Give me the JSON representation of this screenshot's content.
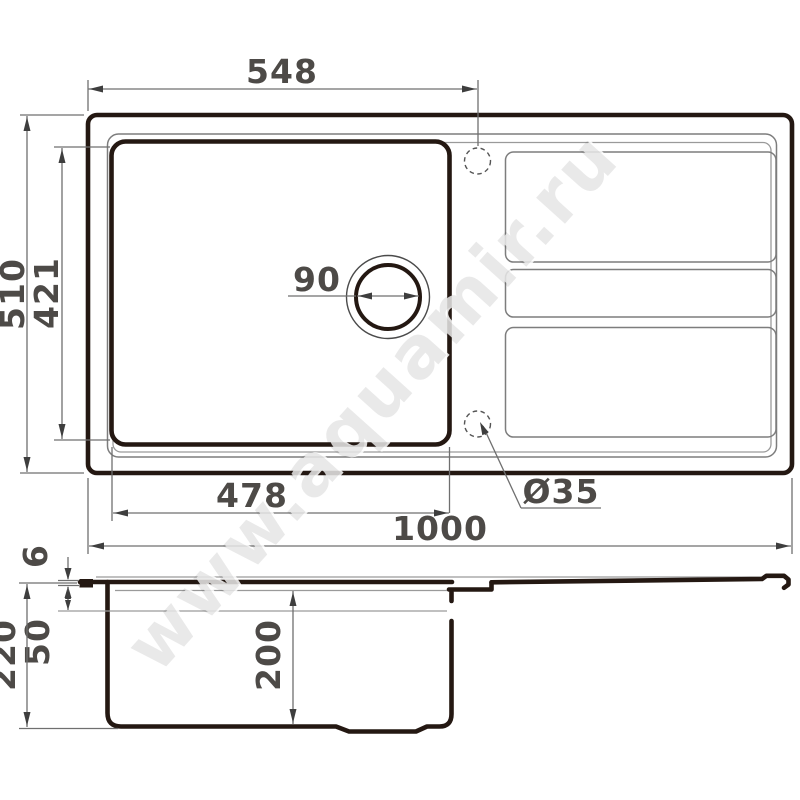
{
  "drawing_title": "kitchen-sink-dimension-drawing",
  "dimensions": {
    "top_width_to_hole": "548",
    "overall_depth": "510",
    "bowl_inner_length": "421",
    "drain_diameter": "90",
    "bowl_width": "478",
    "overall_width": "1000",
    "faucet_hole_diameter": "Ø35",
    "rim_edge_thickness": "6",
    "rim_ledge_height": "50",
    "overall_height": "220",
    "bowl_inner_depth": "200"
  },
  "watermark": "www.aquamir.ru",
  "colors": {
    "outline_thick": "#241812",
    "outline_thin": "#7d7d7d",
    "dimension_text": "#4d4a47",
    "background": "#ffffff"
  }
}
